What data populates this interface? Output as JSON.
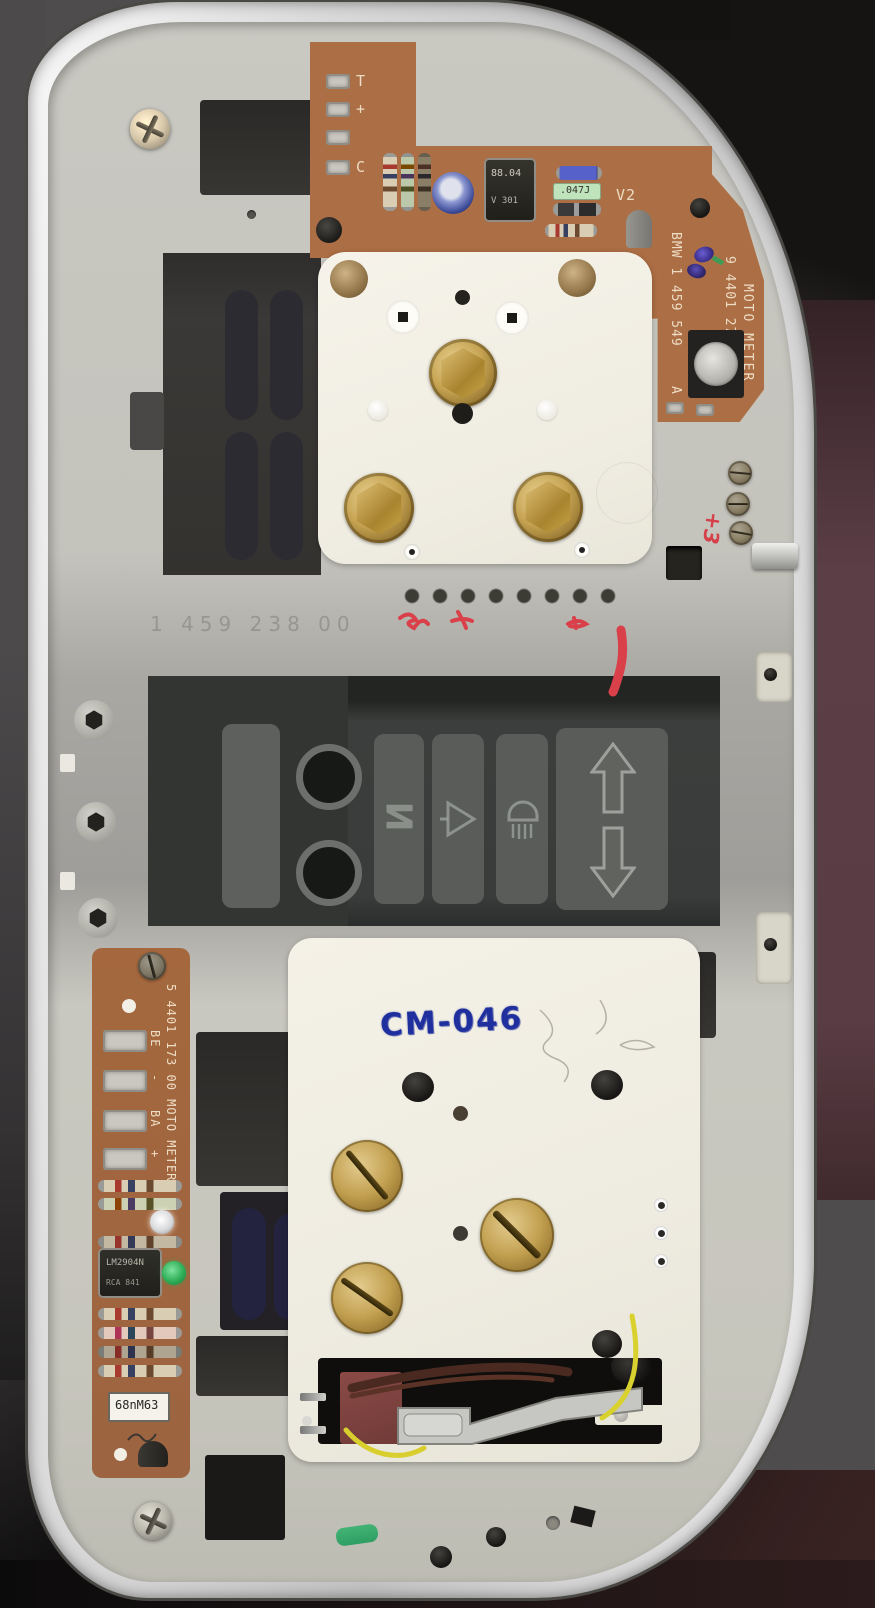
{
  "pcb_top": {
    "pad_labels": {
      "t": "T",
      "plus": "+",
      "c": "C"
    },
    "ic": {
      "line1": "88.04",
      "line2": "V 301"
    },
    "film_cap_label": ".047J",
    "transistor_ref": "V2",
    "silk": {
      "brand": "MOTO METER",
      "part_number": "9 4401 272 10",
      "bmw_number": "BMW 1 459 549",
      "revision": "A"
    }
  },
  "backplate": {
    "embossed_number": "1 459 238 00",
    "red_handwriting": "+3"
  },
  "lower_plate": {
    "ink_stamp": "CM-046"
  },
  "pcb_bottom": {
    "silk_part_number": "5 4401 173 00 MOTO METER",
    "pad_labels": {
      "be": "BE",
      "minus": "-",
      "ba": "BA",
      "plus": "+"
    },
    "ic": {
      "line1": "LM2904N",
      "line2": "RCA 841"
    },
    "cap_label": "68nM63"
  },
  "indicator_symbols": {
    "neutral": "N",
    "turn_signal": "turn-signal-triangle-icon",
    "high_beam": "high-beam-lamp-icon",
    "up": "hollow-arrow-up-icon",
    "down": "hollow-arrow-down-icon"
  },
  "colors": {
    "pcb": "#ac6e44",
    "housing": "#c4c3bc",
    "stamp_blue": "#1f2f9e",
    "mark_red": "#d9404a",
    "brass": "#c6a453"
  }
}
